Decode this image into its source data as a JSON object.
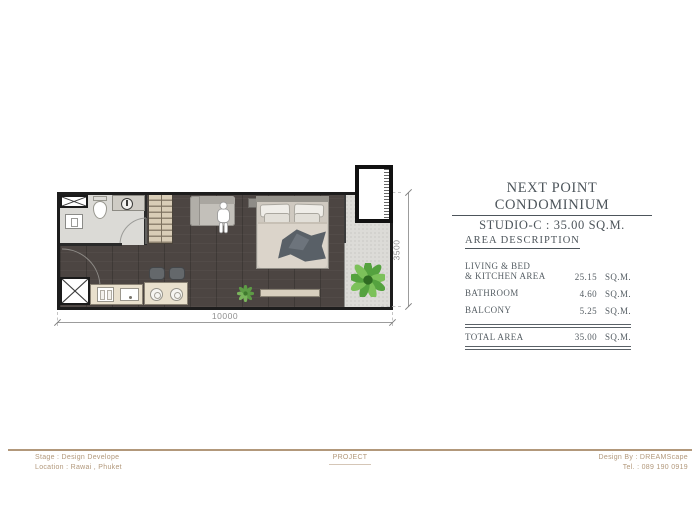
{
  "title_block": {
    "title": "NEXT POINT CONDOMINIUM",
    "subtitle": "STUDIO-C : 35.00 SQ.M."
  },
  "area_description": {
    "heading": "AREA DESCRIPTION",
    "rows": [
      {
        "label1": "LIVING & BED",
        "label2": "& KITCHEN AREA",
        "value": "25.15",
        "unit": "SQ.M."
      },
      {
        "label1": "BATHROOM",
        "value": "4.60",
        "unit": "SQ.M."
      },
      {
        "label1": "BALCONY",
        "value": "5.25",
        "unit": "SQ.M."
      }
    ],
    "total_row": {
      "label": "TOTAL AREA",
      "value": "35.00",
      "unit": "SQ.M."
    }
  },
  "dimensions": {
    "width": "10000",
    "height": "3500"
  },
  "footer": {
    "stage": "Stage : Design Develope",
    "location": "Location : Rawai , Phuket",
    "project_label": "PROJECT",
    "design_by": "Design By : DREAMScape",
    "tel": "Tel. : 089 190 0919"
  },
  "colors": {
    "accent_tan": "#b2987b",
    "panel_text": "#4d555b",
    "dimension_text": "#8f8f8f",
    "floor_dark": "#4c4542",
    "bathroom_floor": "#e4e3df",
    "balcony_floor": "#dcdbd7",
    "wall": "#1d1d1d"
  }
}
